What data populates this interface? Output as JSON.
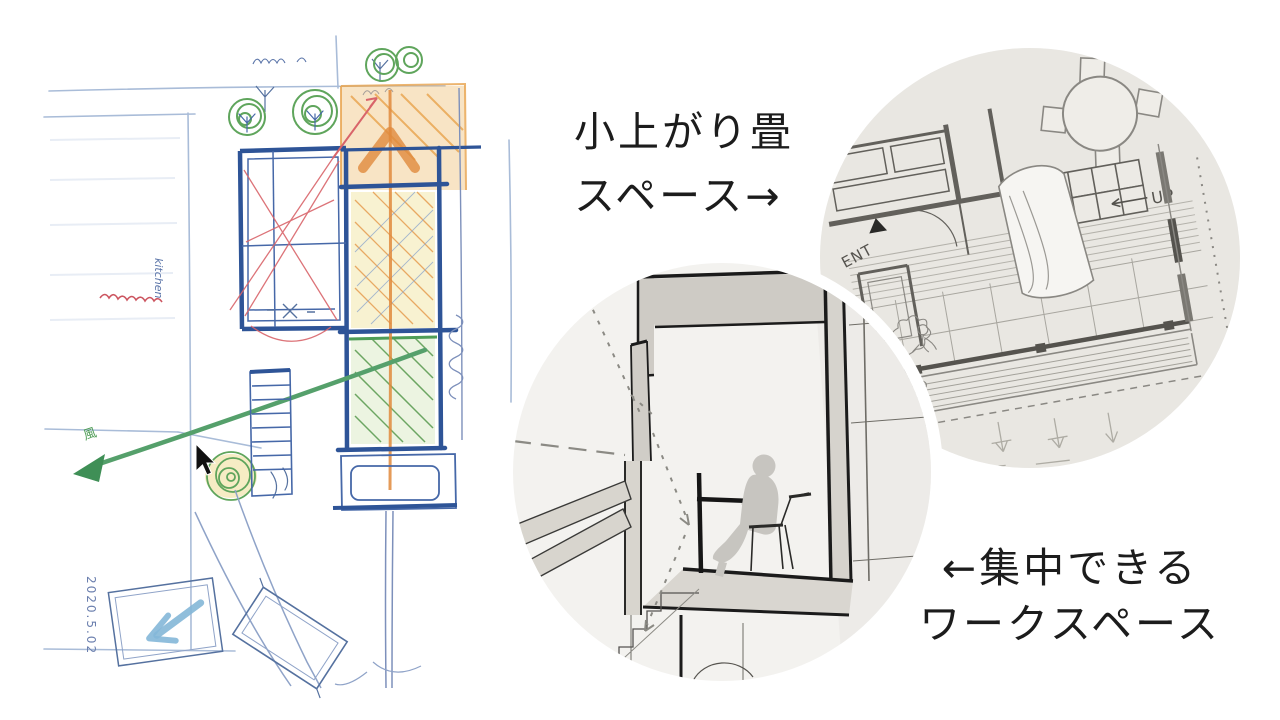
{
  "canvas": {
    "width": 1280,
    "height": 720,
    "background": "#ffffff"
  },
  "captions": {
    "tatami": {
      "line1": "小上がり畳",
      "line2": "スペース→"
    },
    "workspace": {
      "line1": "←集中できる",
      "line2": "ワークスペース"
    }
  },
  "sketch": {
    "kind": "hand-drawn floor plan concept sketch",
    "date_note": "2020.5.02",
    "wind_note": "風",
    "kitchen_note": "kitchen",
    "colors": {
      "ink_blue": "#2e5497",
      "light_blue": "#9db1d4",
      "green": "#4f9d57",
      "arrow_green": "#55a06b",
      "orange": "#e08a3c",
      "red": "#d9646a",
      "yellow": "#f0e39a"
    }
  },
  "plan_photo": {
    "kind": "photo of printed first-floor plan",
    "ent_label": "ENT",
    "up_label": "UP",
    "paper_color": "#e9e7e2",
    "line_color": "#75736e"
  },
  "section_photo": {
    "kind": "sectional perspective of workspace with seated figure",
    "paper_color": "#f3f2ef",
    "wall_color": "#1b1b1b",
    "shade_color": "#d6d3cd"
  },
  "cursor": {
    "x": 196,
    "y": 444
  }
}
